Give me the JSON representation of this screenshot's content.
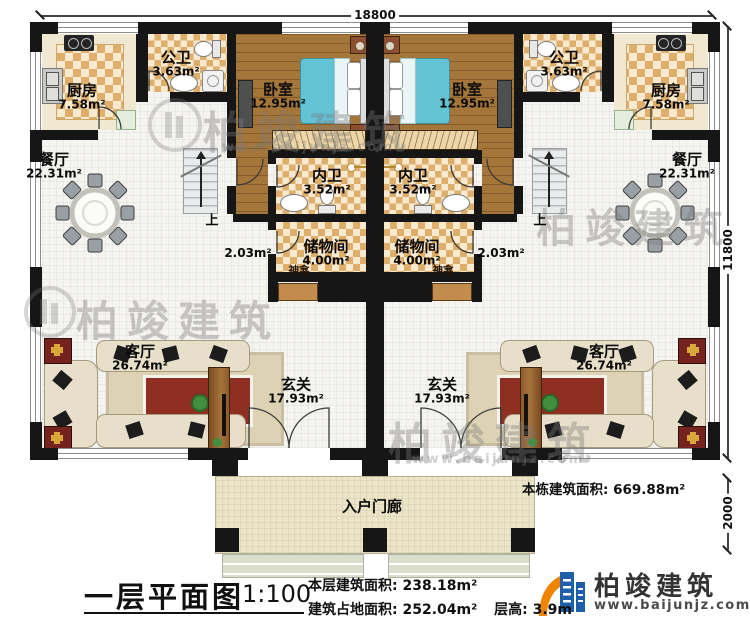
{
  "plan": {
    "dimensions": {
      "top_width": "18800",
      "right_height": "11800",
      "porch_depth": "2000"
    },
    "rooms": {
      "kitchen": {
        "name": "厨房",
        "area": "7.58m²"
      },
      "public_bath": {
        "name": "公卫",
        "area": "3.63m²"
      },
      "bedroom": {
        "name": "卧室",
        "area": "12.95m²"
      },
      "ensuite_bath": {
        "name": "内卫",
        "area": "3.52m²"
      },
      "storage": {
        "name": "储物间",
        "area": "4.00m²"
      },
      "dining": {
        "name": "餐厅",
        "area": "22.31m²"
      },
      "living": {
        "name": "客厅",
        "area": "26.74m²"
      },
      "foyer": {
        "name": "玄关",
        "area": "17.93m²"
      },
      "porch": {
        "name": "入户门廊"
      },
      "hall_area": "2.03m²",
      "shrine": "神龛",
      "stairs_up": "上"
    },
    "building_total_label": "本栋建筑面积:",
    "building_total_value": "669.88m²"
  },
  "title_block": {
    "drawing_title": "一层平面图",
    "scale": "1:100",
    "floor_area_label": "本层建筑面积:",
    "floor_area_value": "238.18m²",
    "site_area_label": "建筑占地面积:",
    "site_area_value": "252.04m²",
    "story_height_label": "层高:",
    "story_height_value": "3.9m"
  },
  "branding": {
    "company": "柏竣建筑",
    "website": "www.baijunjz.com"
  },
  "watermark": {
    "text": "柏竣建筑",
    "url": "www.baijunjz.com"
  },
  "colors": {
    "wall": "#161616",
    "checker_tile": "#dfae6b",
    "wood_floor": "#a5763a",
    "bed_blue": "#64c2d5",
    "shrine_wood": "#c18c4e",
    "logo_blue": "#1d5fa8",
    "logo_orange": "#f08300"
  }
}
